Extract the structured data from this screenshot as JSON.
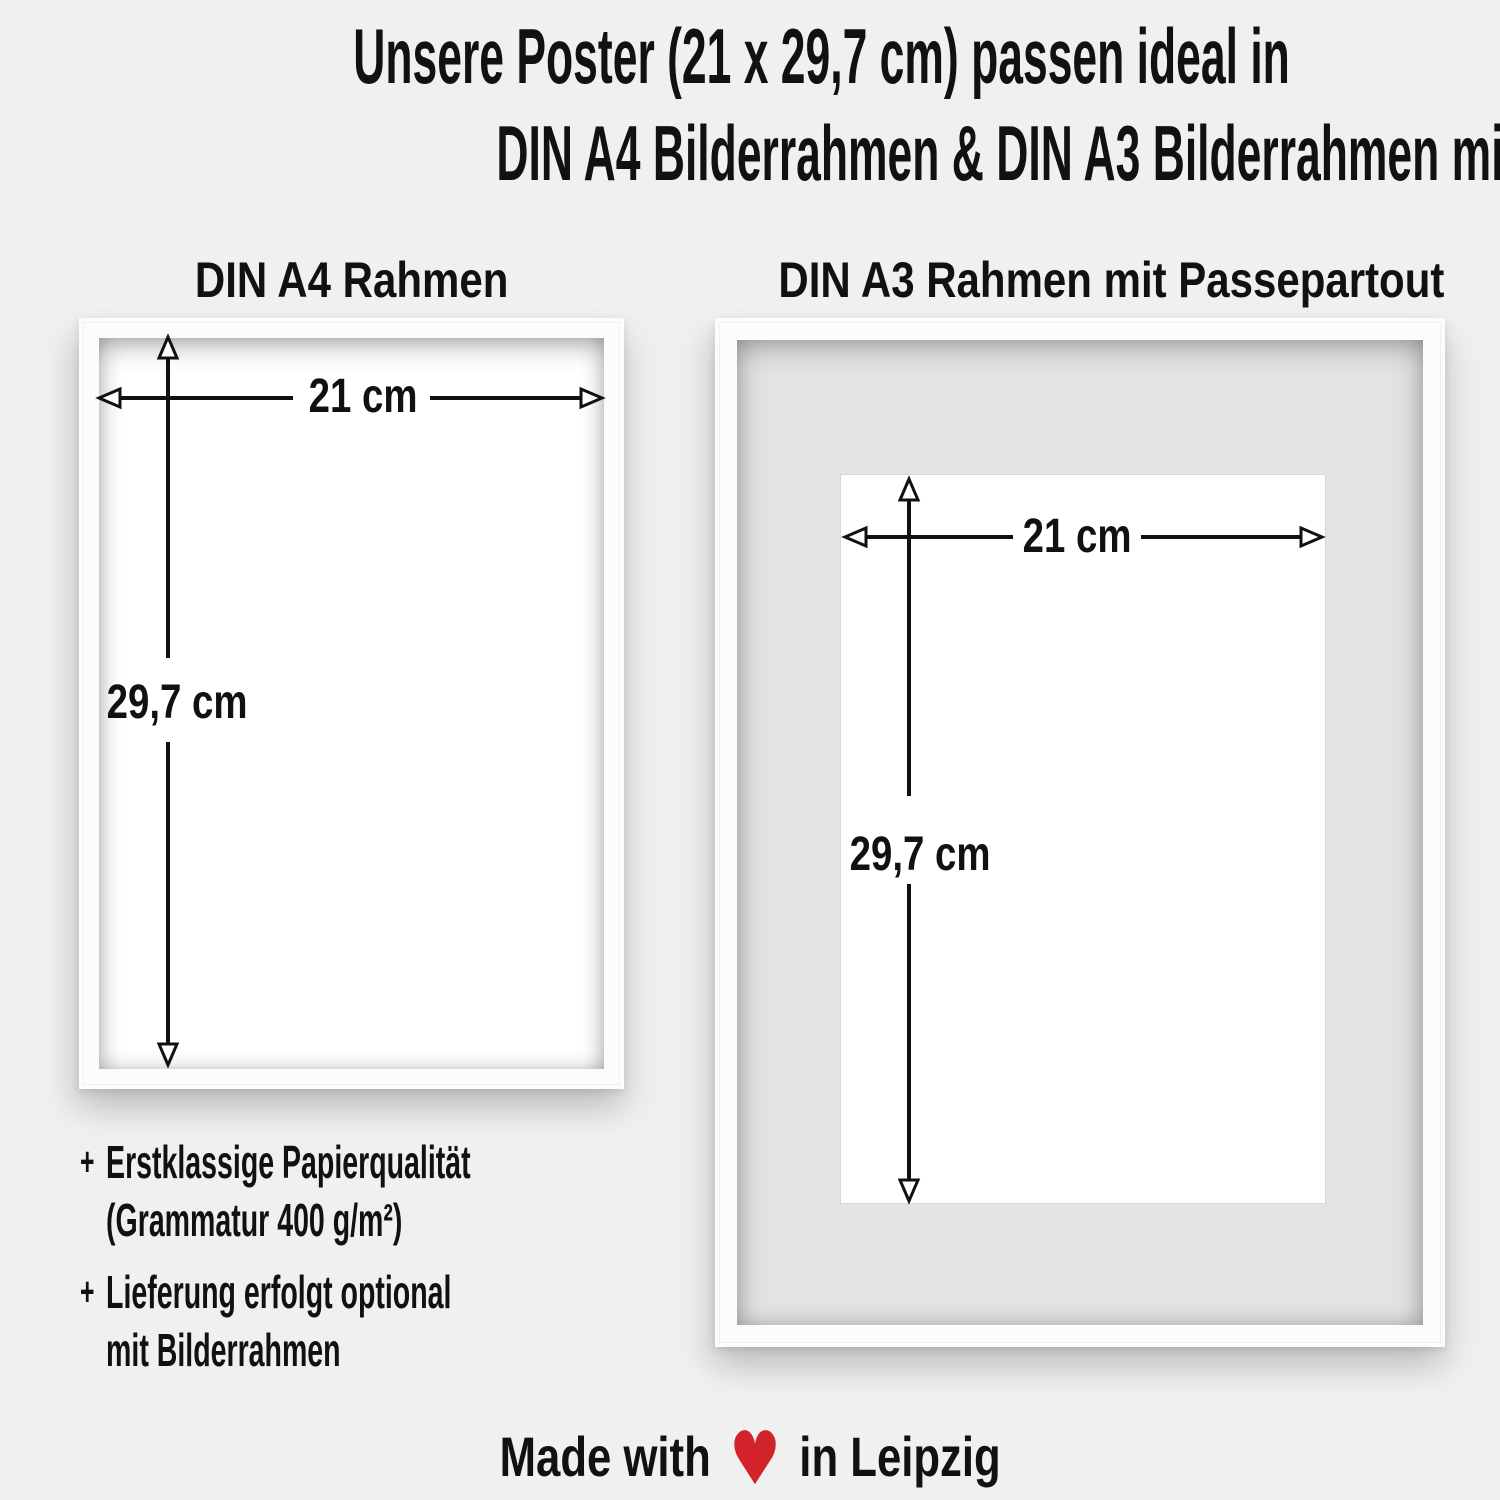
{
  "page": {
    "background_color": "#f0f0f0",
    "text_color": "#111111",
    "heart_color": "#d2232a",
    "mat_color": "#e3e3e3"
  },
  "header": {
    "title_line1": "Unsere Poster (21 x 29,7 cm) passen ideal in",
    "title_line2": "DIN A4 Bilderrahmen & DIN A3 Bilderrahmen mit Passepartout"
  },
  "frames": {
    "a4": {
      "label": "DIN A4 Rahmen",
      "width_label": "21 cm",
      "height_label": "29,7 cm"
    },
    "a3": {
      "label": "DIN A3 Rahmen mit Passepartout",
      "width_label": "21 cm",
      "height_label": "29,7 cm"
    }
  },
  "features": [
    {
      "marker": "+",
      "line1": "Erstklassige Papierqualität",
      "line2": "(Grammatur 400 g/m²)"
    },
    {
      "marker": "+",
      "line1": "Lieferung erfolgt optional",
      "line2": "mit Bilderrahmen"
    }
  ],
  "footer": {
    "made_with": "Made with",
    "heart_symbol": "♥",
    "location": "in Leipzig"
  }
}
